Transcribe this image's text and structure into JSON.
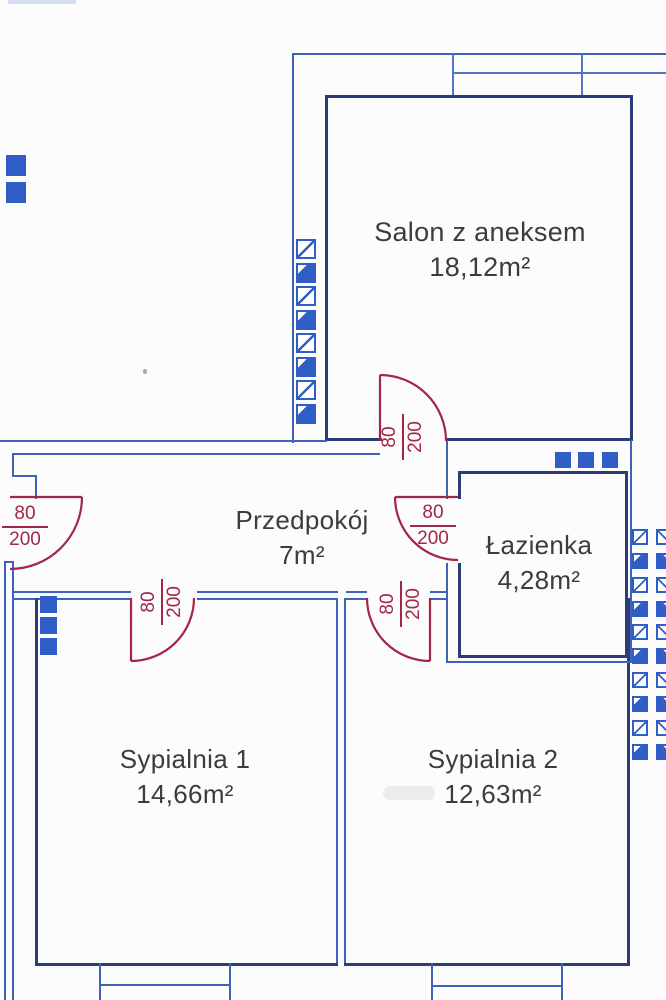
{
  "rooms": [
    {
      "name": "Salon z aneksem",
      "area": "18,12m²"
    },
    {
      "name": "Przedpokój",
      "area": "7m²"
    },
    {
      "name": "Łazienka",
      "area": "4,28m²"
    },
    {
      "name": "Sypialnia 1",
      "area": "14,66m²"
    },
    {
      "name": "Sypialnia 2",
      "area": "12,63m²"
    }
  ],
  "doors": [
    {
      "name": "entrance-door",
      "width": "80",
      "height": "200"
    },
    {
      "name": "salon-door",
      "width": "80",
      "height": "200"
    },
    {
      "name": "bathroom-door",
      "width": "80",
      "height": "200"
    },
    {
      "name": "bedroom1-door",
      "width": "80",
      "height": "200"
    },
    {
      "name": "bedroom2-door",
      "width": "80",
      "height": "200"
    }
  ],
  "colors": {
    "wall_blue": "#3f63b8",
    "wall_dark_blue": "#2b3c78",
    "door_red": "#a32747",
    "symbol_blue": "#2e5ec6",
    "label_text": "#3b3b40"
  }
}
